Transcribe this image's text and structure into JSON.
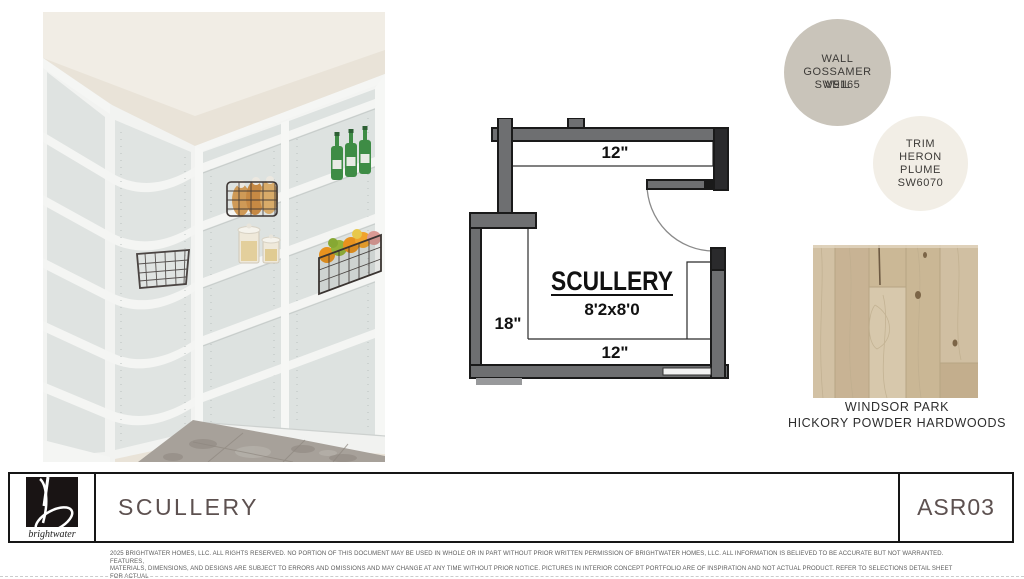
{
  "floorplan": {
    "room_label": "SCULLERY",
    "room_size": "8'2x8'0",
    "dim_top": "12\"",
    "dim_left": "18\"",
    "dim_bottom": "12\""
  },
  "paint": {
    "wall": {
      "line1": "WALL",
      "line2": "GOSSAMER",
      "veil": "VEIL",
      "code": "SW9165",
      "color": "#c9c4ba"
    },
    "trim": {
      "line1": "TRIM",
      "line2": "HERON",
      "line3": "PLUME",
      "code": "SW6070",
      "color": "#f2eee6"
    }
  },
  "flooring": {
    "name": "WINDSOR PARK",
    "type": "HICKORY POWDER HARDWOODS",
    "base_color": "#cdb99c"
  },
  "footer": {
    "title": "SCULLERY",
    "code": "ASR03",
    "logo_text": "brightwater",
    "accent_color": "#5d5150"
  },
  "legal": {
    "line1": "2025 BRIGHTWATER HOMES, LLC. ALL RIGHTS RESERVED. NO PORTION OF THIS DOCUMENT MAY BE USED IN WHOLE OR IN PART WITHOUT PRIOR WRITTEN PERMISSION OF BRIGHTWATER HOMES, LLC. ALL INFORMATION IS BELIEVED TO BE ACCURATE BUT NOT WARRANTED. FEATURES,",
    "line2": "MATERIALS, DIMENSIONS, AND DESIGNS ARE SUBJECT TO ERRORS AND OMISSIONS AND MAY CHANGE AT ANY TIME WITHOUT PRIOR NOTICE. PICTURES IN INTERIOR CONCEPT PORTFOLIO ARE OF INSPIRATION AND NOT ACTUAL PRODUCT. REFER TO SELECTIONS DETAIL SHEET FOR ACTUAL",
    "line3": "HOME SPECIFICATIONS. ARTWORK, FURNITURE, AND ACCESSORIES ARE NOT INCLUDED."
  }
}
